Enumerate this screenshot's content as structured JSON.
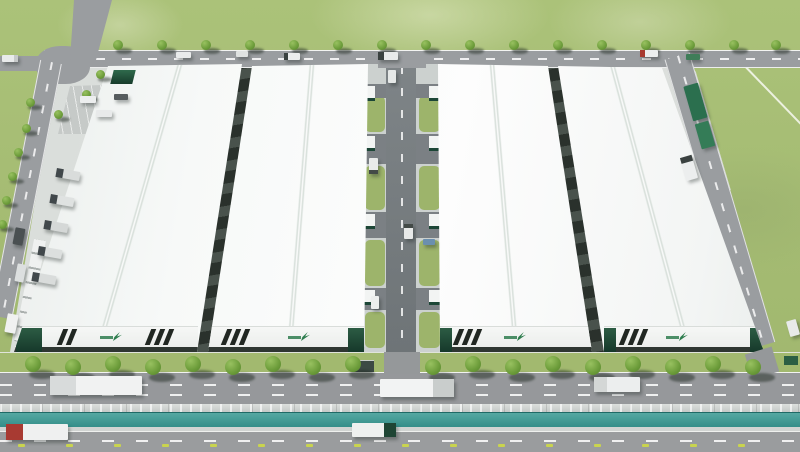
{
  "scene": {
    "type": "aerial-3d-architectural-rendering",
    "subject": "Industrial logistics park with four white-roofed warehouses, central service corridor, perimeter roads, tree-lined boulevard and water canal in the foreground",
    "colors": {
      "grass": "#a5bc73",
      "grass_light": "#b3c983",
      "road_gray": "#9a9da0",
      "road_dark": "#73787a",
      "roof_white": "#f7f9f8",
      "facade_white": "#f2f3f2",
      "stripe_black": "#212722",
      "accent_green_dark": "#1c4636",
      "logo_green": "#2e7d4e",
      "water_teal": "#35908b",
      "concrete": "#ccd1ce",
      "tree_green": "#6c9c3a",
      "marker_yellow": "#c9d44e",
      "truck_cab_red": "#a83a30"
    },
    "counts": {
      "buildings": 4,
      "trees": 43,
      "vehicles": 32,
      "curb_markers": 16
    },
    "buildings": [
      {
        "name": "warehouse-1",
        "facade_x": 14,
        "facade_w": 184,
        "ridge": {
          "x": 180,
          "h": 292,
          "rot": 16
        },
        "stripe_groups": [
          {
            "x": 60,
            "n": 2
          },
          {
            "x": 148,
            "n": 3
          }
        ],
        "logo_x": 100,
        "end_blocks": [
          {
            "x": 16,
            "w": 26
          }
        ],
        "canopy": {
          "x": 112,
          "y": 70,
          "w": 22,
          "h": 14
        }
      },
      {
        "name": "warehouse-2",
        "facade_x": 208,
        "facade_w": 157,
        "ridge": {
          "x": 312,
          "h": 290,
          "rot": 4.5
        },
        "stripe_groups": [
          {
            "x": 224,
            "n": 3
          }
        ],
        "logo_x": 288,
        "end_blocks": [
          {
            "x": 348,
            "w": 16
          }
        ],
        "canopy": null
      },
      {
        "name": "warehouse-3",
        "facade_x": 440,
        "facade_w": 153,
        "ridge": {
          "x": 492,
          "h": 290,
          "rot": -4.8
        },
        "stripe_groups": [
          {
            "x": 456,
            "n": 3
          }
        ],
        "logo_x": 504,
        "end_blocks": [
          {
            "x": 440,
            "w": 12
          }
        ],
        "canopy": null
      },
      {
        "name": "warehouse-4",
        "facade_x": 604,
        "facade_w": 161,
        "ridge": {
          "x": 612,
          "h": 288,
          "rot": -15
        },
        "stripe_groups": [
          {
            "x": 622,
            "n": 3
          }
        ],
        "logo_x": 666,
        "end_blocks": [
          {
            "x": 604,
            "w": 12
          },
          {
            "x": 750,
            "w": 13
          }
        ],
        "canopy": null
      }
    ],
    "corridor": {
      "grass": [
        {
          "y": 96,
          "h": 36
        },
        {
          "y": 166,
          "h": 44
        },
        {
          "y": 240,
          "h": 46
        },
        {
          "y": 312,
          "h": 36
        }
      ],
      "stubs": [
        {
          "y": 84,
          "h": 14
        },
        {
          "y": 134,
          "h": 30
        },
        {
          "y": 212,
          "h": 26
        },
        {
          "y": 288,
          "h": 22
        }
      ],
      "platforms": [
        86,
        136,
        214,
        290
      ]
    },
    "trees": {
      "boulevard": {
        "size": 16,
        "y": 356,
        "x": [
          33,
          73,
          113,
          153,
          193,
          233,
          273,
          313,
          353,
          433,
          473,
          513,
          553,
          593,
          633,
          673,
          713,
          753
        ]
      },
      "top_road": {
        "size": 10,
        "y": 40,
        "x": [
          118,
          162,
          206,
          250,
          294,
          338,
          382,
          426,
          470,
          514,
          558,
          602,
          646,
          690,
          734,
          776
        ]
      },
      "west_road": {
        "size": 9,
        "pts": [
          {
            "x": 100,
            "y": 70
          },
          {
            "x": 86,
            "y": 90
          },
          {
            "x": 58,
            "y": 110
          },
          {
            "x": 30,
            "y": 98
          },
          {
            "x": 26,
            "y": 124
          },
          {
            "x": 18,
            "y": 148
          },
          {
            "x": 12,
            "y": 172
          },
          {
            "x": 6,
            "y": 196
          },
          {
            "x": 2,
            "y": 220
          }
        ]
      }
    },
    "vehicles": {
      "top_road": [
        {
          "x": 2,
          "y": 55,
          "w": 16,
          "h": 7,
          "body": "#e9ebeb",
          "cab": "#c6c9c9",
          "cab_side": "right"
        },
        {
          "x": 176,
          "y": 52,
          "w": 15,
          "h": 6,
          "body": "#e9ebeb"
        },
        {
          "x": 236,
          "y": 51,
          "w": 12,
          "h": 6,
          "body": "#dfe2e1"
        },
        {
          "x": 284,
          "y": 53,
          "w": 16,
          "h": 7,
          "body": "#ebedec",
          "cab": "#3a4240",
          "cab_side": "left"
        },
        {
          "x": 378,
          "y": 52,
          "w": 20,
          "h": 8,
          "body": "#e8eaea",
          "cab": "#39413f",
          "cab_side": "left"
        },
        {
          "x": 640,
          "y": 50,
          "w": 18,
          "h": 7,
          "body": "#eceeee",
          "cab": "#a83a30",
          "cab_side": "left"
        },
        {
          "x": 686,
          "y": 54,
          "w": 14,
          "h": 6,
          "body": "#3f7d58"
        }
      ],
      "boulevard": [
        {
          "x": 50,
          "y": 376,
          "w": 92,
          "h": 19,
          "body": "#f1f2f2",
          "cab": "#d8dbdb",
          "cab_side": "left"
        },
        {
          "x": 380,
          "y": 379,
          "w": 74,
          "h": 18,
          "body": "#f2f3f3",
          "cab": "#c9cdcc",
          "cab_side": "right"
        },
        {
          "x": 594,
          "y": 377,
          "w": 46,
          "h": 15,
          "body": "#eceeee",
          "cab": "#d4d7d6",
          "cab_side": "left"
        }
      ],
      "front_road": [
        {
          "x": 6,
          "y": 424,
          "w": 62,
          "h": 16,
          "body": "#eff0f0",
          "cab": "#a83a32",
          "cab_side": "left"
        },
        {
          "x": 352,
          "y": 423,
          "w": 44,
          "h": 14,
          "body": "#eef0ef",
          "cab": "#1e4534",
          "cab_side": "right"
        }
      ],
      "corridor": [
        {
          "x": 369,
          "y": 158,
          "w": 9,
          "h": 16,
          "body": "#e9ebea",
          "cab": "#434a47",
          "cab_side": "bottom"
        },
        {
          "x": 404,
          "y": 224,
          "w": 9,
          "h": 15,
          "body": "#e7e9e8",
          "cab": "#434a47",
          "cab_side": "top"
        },
        {
          "x": 371,
          "y": 296,
          "w": 8,
          "h": 13,
          "body": "#eceeed"
        },
        {
          "x": 388,
          "y": 70,
          "w": 8,
          "h": 13,
          "body": "#e5e8e7"
        },
        {
          "x": 423,
          "y": 239,
          "w": 12,
          "h": 6,
          "body": "#6b8fae"
        }
      ],
      "west_docks": [
        {
          "x": 56,
          "y": 170,
          "w": 24,
          "h": 9,
          "rot": 10,
          "body": "#d9dcdb",
          "cab": "#41484b",
          "cab_side": "left"
        },
        {
          "x": 50,
          "y": 196,
          "w": 24,
          "h": 9,
          "rot": 10,
          "body": "#dfe2e1",
          "cab": "#41484b",
          "cab_side": "left"
        },
        {
          "x": 44,
          "y": 222,
          "w": 24,
          "h": 9,
          "rot": 10,
          "body": "#d5d8d7",
          "cab": "#41484b",
          "cab_side": "left"
        },
        {
          "x": 38,
          "y": 248,
          "w": 24,
          "h": 9,
          "rot": 10,
          "body": "#dcdfde",
          "cab": "#41484b",
          "cab_side": "left"
        },
        {
          "x": 32,
          "y": 274,
          "w": 24,
          "h": 9,
          "rot": 10,
          "body": "#d9dcdb",
          "cab": "#41484b",
          "cab_side": "left"
        }
      ],
      "east_side": [
        {
          "name": "container-trailer",
          "x": 688,
          "y": 84,
          "w": 15,
          "h": 36,
          "rot": -16,
          "body": "#2b6f4e"
        },
        {
          "name": "container-trailer",
          "x": 698,
          "y": 122,
          "w": 14,
          "h": 26,
          "rot": -16,
          "body": "#347c57"
        },
        {
          "x": 683,
          "y": 156,
          "w": 12,
          "h": 24,
          "rot": -16,
          "body": "#eceeee",
          "cab": "#3a4140",
          "cab_side": "top"
        },
        {
          "x": 788,
          "y": 320,
          "w": 10,
          "h": 16,
          "rot": -16,
          "body": "#e8eaea"
        }
      ],
      "west_road": [
        {
          "x": 14,
          "y": 228,
          "w": 10,
          "h": 17,
          "rot": 11,
          "body": "#4a5052"
        },
        {
          "x": 16,
          "y": 264,
          "w": 9,
          "h": 18,
          "rot": 11,
          "body": "#dcdfdf"
        },
        {
          "x": 6,
          "y": 314,
          "w": 11,
          "h": 19,
          "rot": 11,
          "body": "#f0f1f1"
        }
      ],
      "parking": [
        {
          "x": 80,
          "y": 96,
          "w": 16,
          "h": 7,
          "body": "#eceeee"
        },
        {
          "x": 96,
          "y": 110,
          "w": 16,
          "h": 7,
          "body": "#e8eaea"
        },
        {
          "x": 114,
          "y": 94,
          "w": 14,
          "h": 6,
          "body": "#565c5e"
        }
      ]
    },
    "markers": {
      "color": "#c9d44e",
      "y": 444,
      "x": [
        18,
        66,
        114,
        162,
        210,
        258,
        306,
        354,
        402,
        450,
        498,
        546,
        594,
        642,
        690,
        738
      ]
    }
  }
}
